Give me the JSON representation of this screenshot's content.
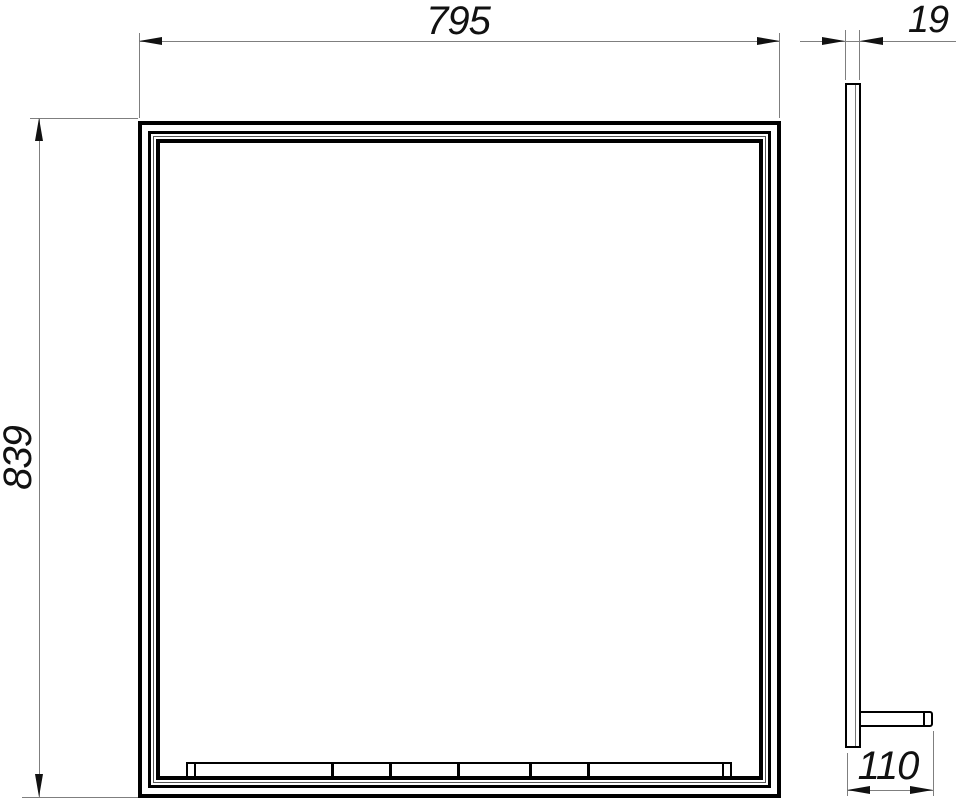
{
  "drawing": {
    "title": "mirror-with-shelf-dimension-drawing",
    "dimensions": {
      "front_width": {
        "label": "795"
      },
      "front_height": {
        "label": "839"
      },
      "side_thickness": {
        "label": "19"
      },
      "shelf_depth": {
        "label": "110"
      }
    },
    "colors": {
      "outline": "#000000",
      "dim_line": "#7f7f7f",
      "text": "#111111",
      "background": "#ffffff"
    }
  }
}
